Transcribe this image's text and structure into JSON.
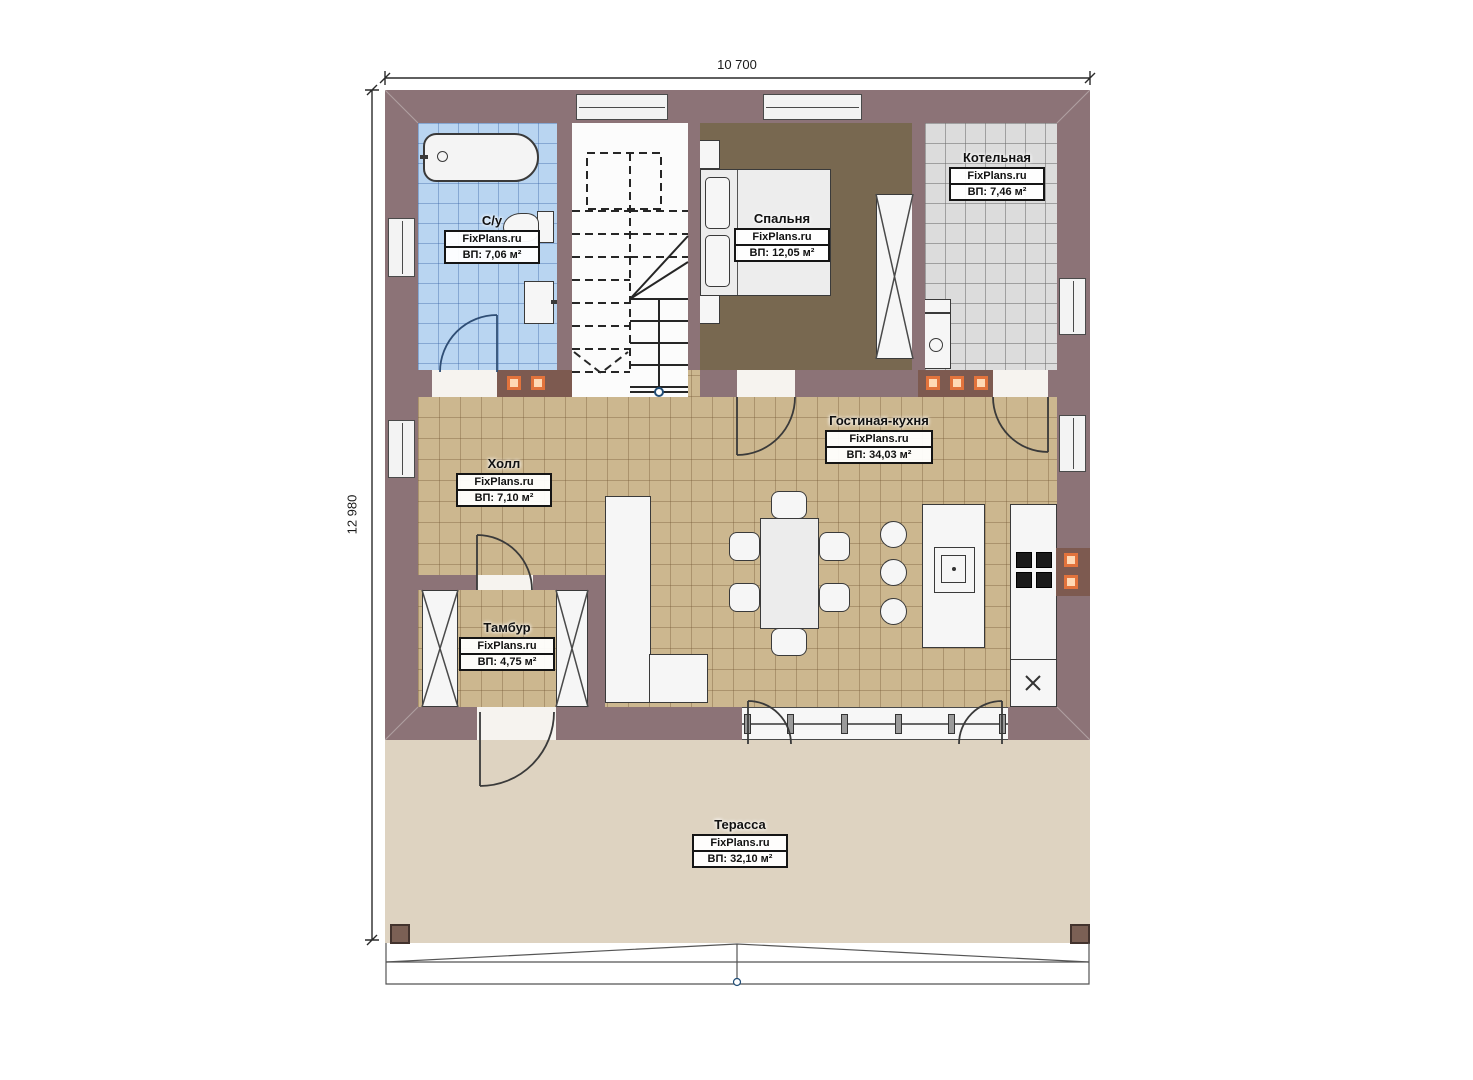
{
  "dimensions": {
    "top": "10 700",
    "left": "12 980"
  },
  "watermark": "FixPlans.ru",
  "rooms": {
    "bathroom": {
      "name": "С/у",
      "area": "ВП: 7,06 м²"
    },
    "bedroom": {
      "name": "Спальня",
      "area": "ВП: 12,05 м²"
    },
    "boiler": {
      "name": "Котельная",
      "area": "ВП: 7,46 м²"
    },
    "living": {
      "name": "Гостиная-кухня",
      "area": "ВП: 34,03 м²"
    },
    "hall": {
      "name": "Холл",
      "area": "ВП: 7,10 м²"
    },
    "vestibule": {
      "name": "Тамбур",
      "area": "ВП: 4,75 м²"
    },
    "terrace": {
      "name": "Терасса",
      "area": "ВП: 32,10 м²"
    }
  },
  "colors": {
    "wall": "#8c7377",
    "floor_living": "#ccb78f",
    "floor_bathroom": "#b9d5f1",
    "floor_boiler": "#dcdcdc",
    "floor_bedroom": "#786850",
    "terrace": "#ded3c1",
    "flue_orange": "#e2733c"
  }
}
